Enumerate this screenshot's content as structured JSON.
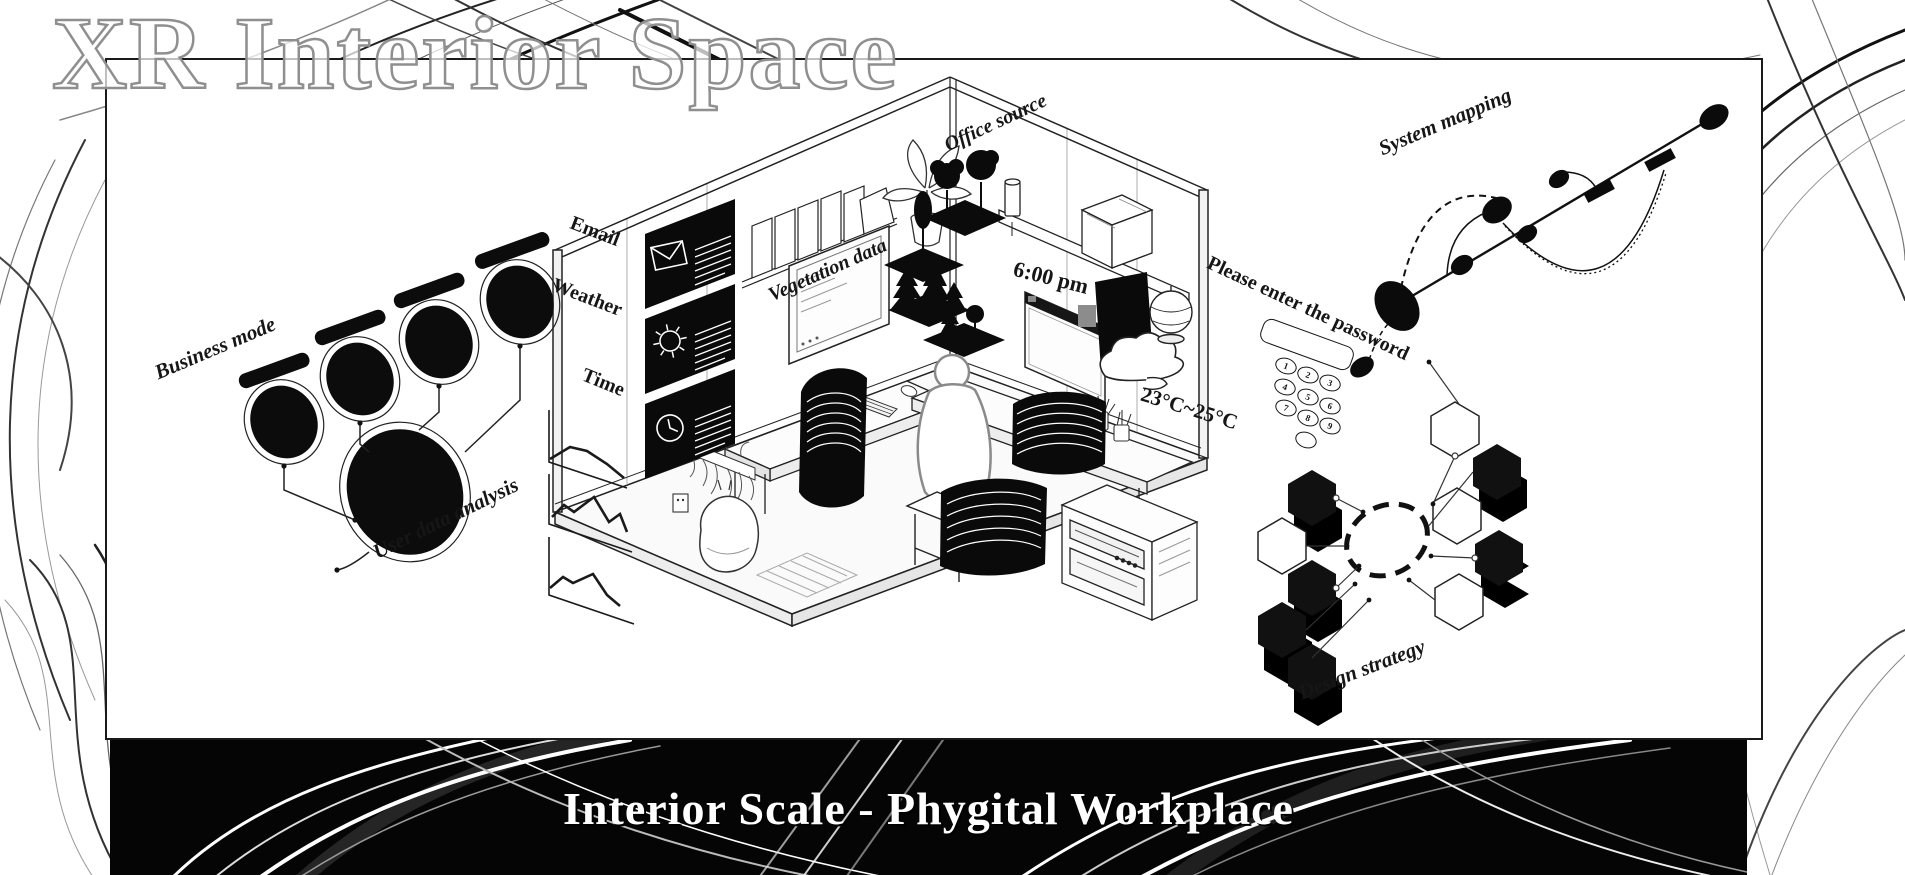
{
  "header": {
    "title": "XR Interior Space"
  },
  "footer": {
    "title": "Interior Scale - Phygital Workplace"
  },
  "colors": {
    "ink": "#161616",
    "paper": "#ffffff",
    "band_bg": "#050505",
    "title_outline": "#8f8f8f"
  },
  "annotations": {
    "business_mode": "Business mode",
    "user_data_analysis": "User data analysis",
    "email": "Email",
    "weather": "Weather",
    "time": "Time",
    "vegetation_data": "Vegetation data",
    "office_source": "Office source",
    "clock_time": "6:00 pm",
    "temperature": "23°C~25°C",
    "system_mapping": "System mapping",
    "design_strategy": "Design strategy"
  },
  "keypad": {
    "prompt": "Please enter the password",
    "keys": [
      "1",
      "2",
      "3",
      "4",
      "5",
      "6",
      "7",
      "8",
      "9",
      ""
    ]
  },
  "icons": {
    "email": "envelope-icon",
    "weather": "sun-icon",
    "time": "clock-icon",
    "sky": "cloud-icon"
  }
}
